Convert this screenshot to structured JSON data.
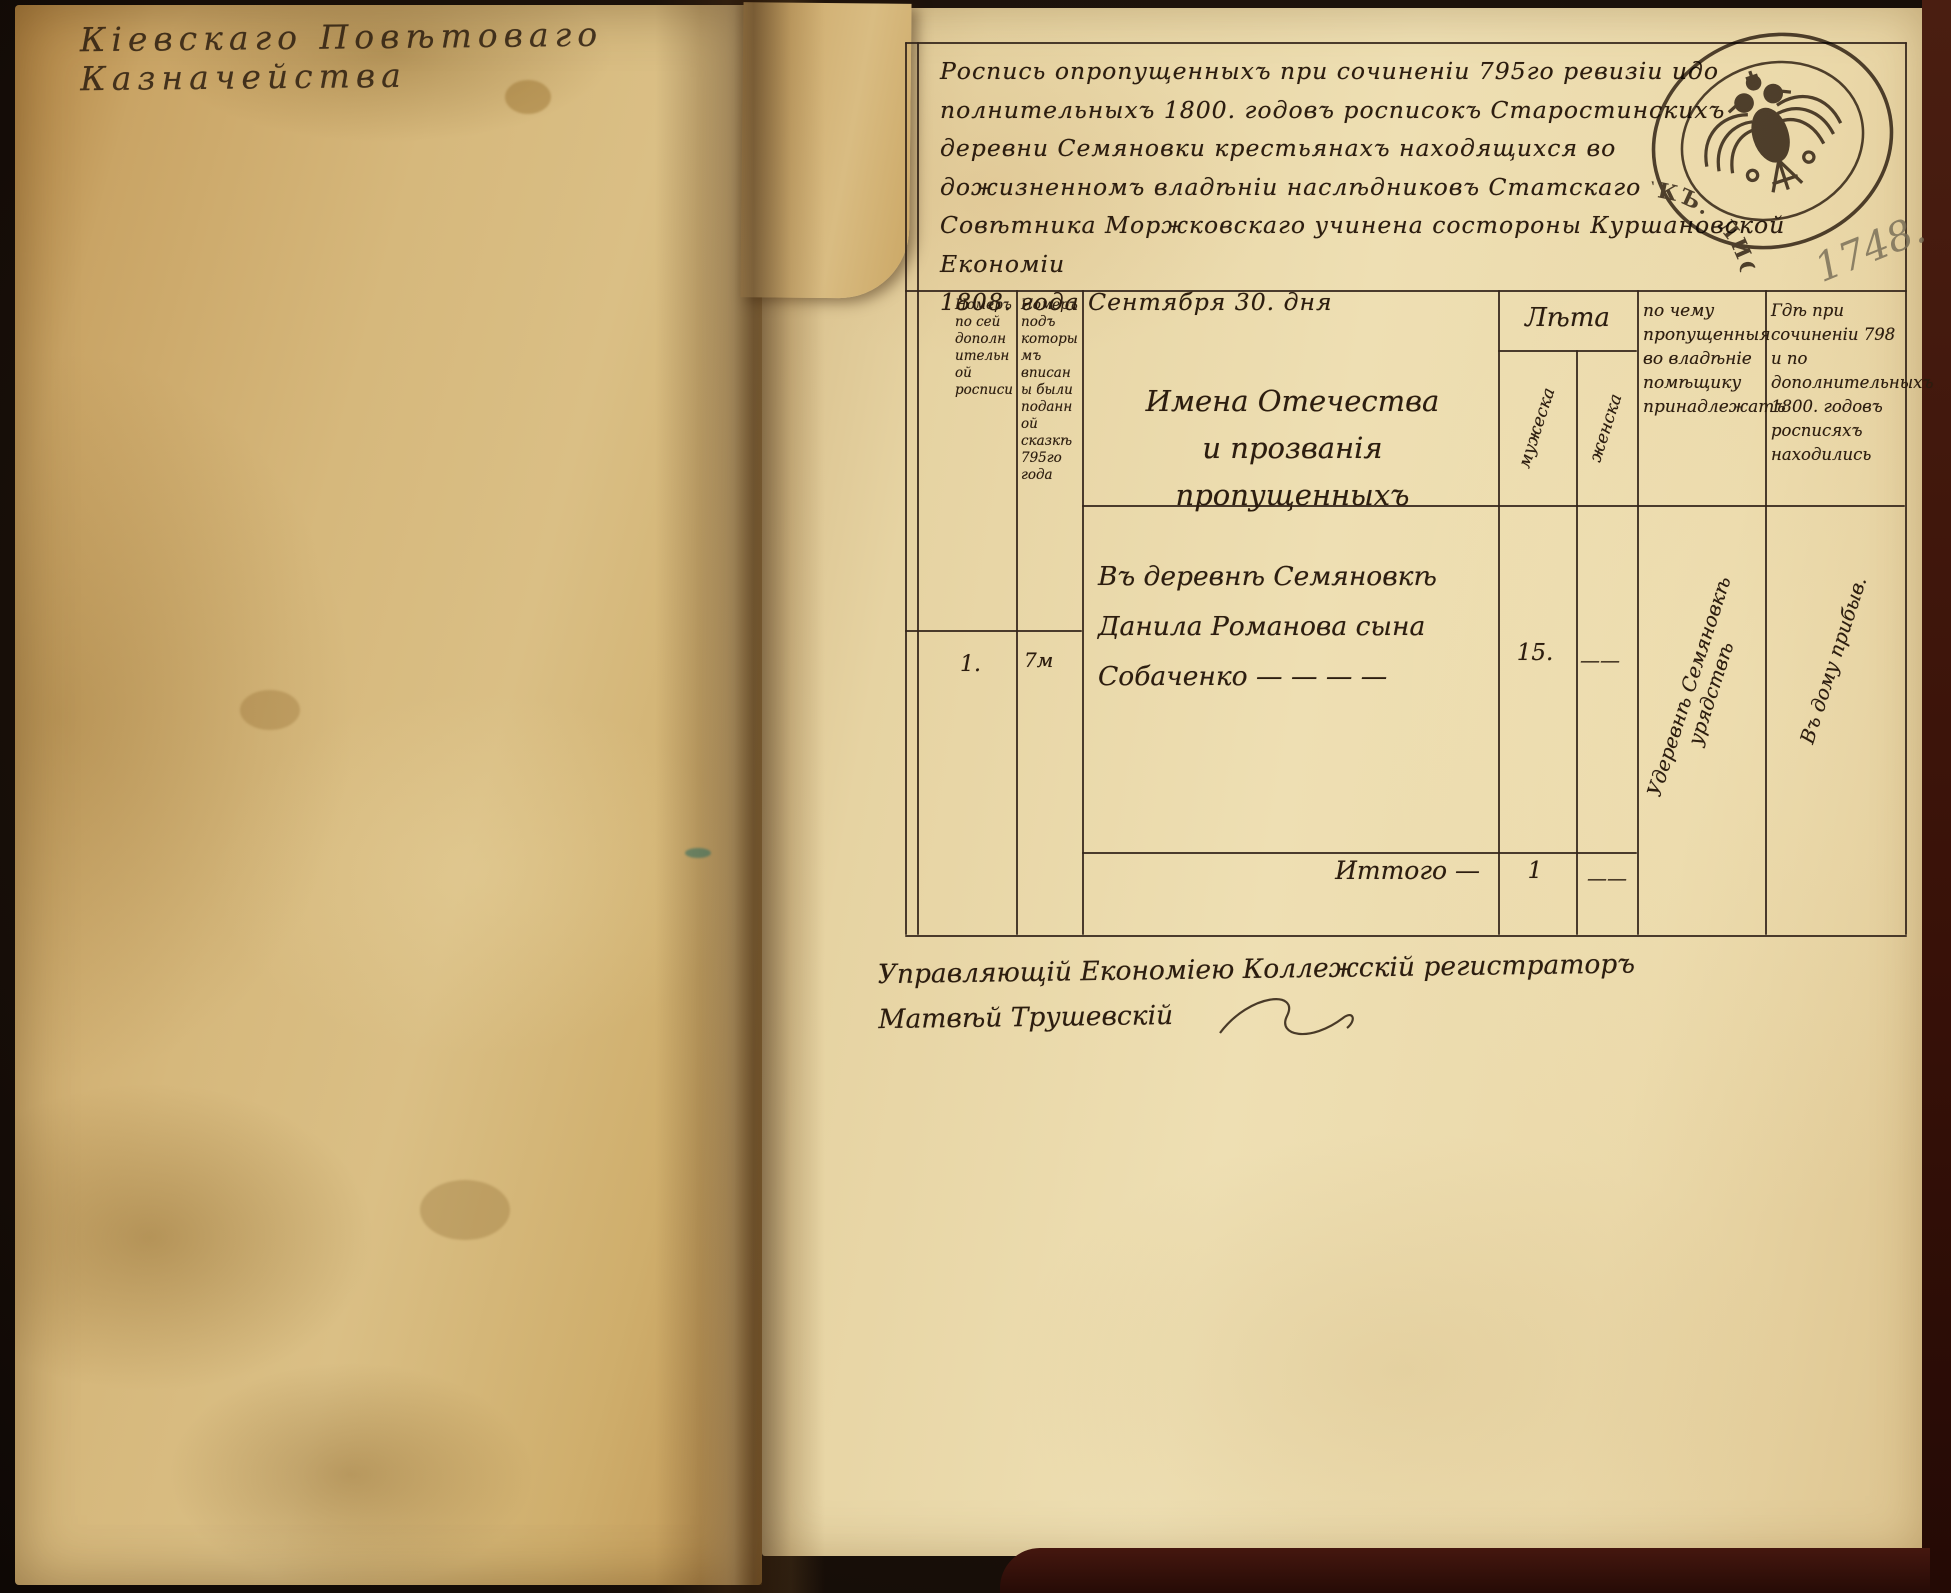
{
  "book": {
    "left_page": {
      "inscription": "Кіевскаго Повѣтоваго Казначейства"
    },
    "right_page": {
      "header_text": "Роспись опропущенныхъ при сочиненіи 795го ревизіи идо\nполнительныхъ 1800. годовъ росписокъ Старостинскихъ\nдеревни Семяновки крестьянахъ находящихся во\nдожизненномъ владѣніи наслѣдниковъ Статскаго\nСовѣтника Моржковскаго учинена состороны Куршановской Економіи\n1808. года Сентября 30. дня",
      "page_number_pencil": "1748.",
      "stamp": {
        "circular_text": "ЛИСТЪ. 1807 ГОДА. ЦѢНА. 30 КОПѢЕКЪ.",
        "center_icon": "double-headed-eagle"
      },
      "table": {
        "col_headers": {
          "num_in_list": "Номеръ по сей дополнительной росписи",
          "num_in_revision": "Номеръ подъ которымъ вписаны были поданной сказкѣ 795го года",
          "names": "Имена Отечества\nи прозванія пропущенныхъ",
          "age_group": "Лѣта",
          "age_male": "мужеска",
          "age_female": "женска",
          "reason": "по чему пропущенныя во владѣніе помѣщику принадлежатъ",
          "where": "Гдѣ при сочиненіи 798 и по дополнительныхъ 1800. годовъ росписяхъ находились"
        },
        "rows": [
          {
            "num_in_list": "1.",
            "num_in_revision": "7м",
            "name": "Въ деревнѣ Семяновкѣ\nДанила Романова сына\nСобаченко — — — —",
            "age_male": "15.",
            "age_female": "——",
            "reason_note": "Удеревнѣ Семяновкѣ урядствѣ",
            "where_note": "Въ дому прибыв."
          }
        ],
        "total": {
          "label": "Иттого —",
          "age_male": "1",
          "age_female": "——"
        }
      },
      "signature_text": "Управляющій Економіею Коллежскій регистраторъ\nМатвѣй Трушевскій"
    }
  },
  "colors": {
    "ink": "#2c1d0f",
    "pencil": "#75халь6b55",
    "paper_left": "#d2b377",
    "paper_right": "#ead9ab",
    "cover": "#3f1d12"
  }
}
